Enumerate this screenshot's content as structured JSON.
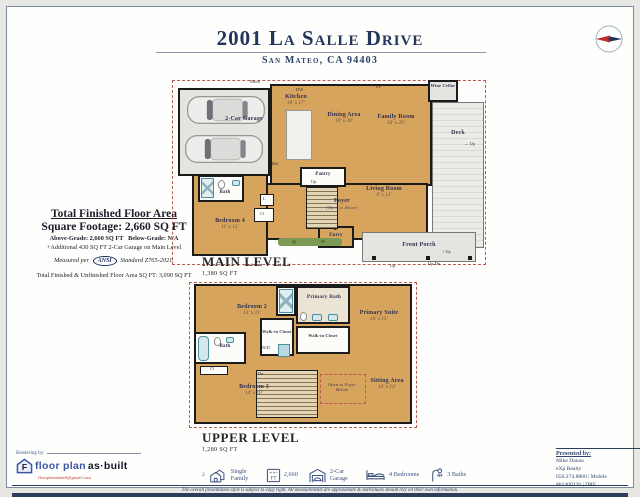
{
  "header": {
    "title": "2001 La Salle Drive",
    "subtitle": "San Mateo, CA 94403"
  },
  "area": {
    "title_line1": "Total Finished Floor Area",
    "title_line2": "Square Footage: 2,660 SQ FT",
    "above_grade": "Above-Grade: 2,660 SQ FT",
    "below_grade": "Below-Grade: N/A",
    "additional": "+Additional 430 SQ FT 2-Car Garage on Main Level",
    "measured_prefix": "Measured per",
    "ansi_label": "ANSI",
    "measured_suffix": "Standard Z765-2021.",
    "total_line": "Total Finished & Unfinished Floor Area SQ FT: 3,090 SQ FT"
  },
  "main": {
    "title": "MAIN LEVEL",
    "sqft": "1,380 SQ FT",
    "rooms": {
      "garage": {
        "name": "2-Car Garage"
      },
      "kitchen": {
        "name": "Kitchen",
        "dims": "10' x 17'"
      },
      "dining": {
        "name": "Dining Area",
        "dims": "10' x 20'"
      },
      "family": {
        "name": "Family Room",
        "dims": "16' x 20'"
      },
      "deck": {
        "name": "Deck"
      },
      "wine": {
        "name": "Wine Cellar"
      },
      "pantry": {
        "name": "Pantry"
      },
      "bath": {
        "name": "Bath"
      },
      "bedroom4": {
        "name": "Bedroom 4",
        "dims": "11' x 12'"
      },
      "foyer": {
        "name": "Foyer",
        "note": "(Open to Above)"
      },
      "living": {
        "name": "Living Room",
        "dims": "9' x 12'"
      },
      "entry": {
        "name": "Entry"
      },
      "porch": {
        "name": "Front Porch"
      }
    }
  },
  "upper": {
    "title": "UPPER LEVEL",
    "sqft": "1,280 SQ FT",
    "rooms": {
      "bedroom2": {
        "name": "Bedroom 2",
        "dims": "13' x 11'"
      },
      "primary_bath": {
        "name": "Primary Bath"
      },
      "primary_suite": {
        "name": "Primary Suite",
        "dims": "14' x 15'"
      },
      "wic1": {
        "name": "Walk-in Closet"
      },
      "wic2": {
        "name": "Walk-in Closet"
      },
      "bath": {
        "name": "Bath"
      },
      "bedroom3": {
        "name": "Bedroom 3",
        "dims": "14' x 10'"
      },
      "sitting": {
        "name": "Sitting Area",
        "dims": "10' x 13'"
      },
      "open_foyer": "Open to Foyer Below"
    }
  },
  "tags": {
    "up": "Up",
    "dn": "Dn",
    "updn": "Up Dn",
    "dw": "DW",
    "fp": "FP",
    "ref": "Ref",
    "cl": "Cl",
    "l": "L",
    "mech": "Mech",
    "wd": "W/D",
    "tri": "▲",
    "up_arrow": "↑",
    "right_arrow": "→"
  },
  "bar": {
    "items": [
      {
        "prefix": "2",
        "label": "Single Family"
      },
      {
        "label": "2,660",
        "icon_text": "FT"
      },
      {
        "label": "2-Car Garage"
      },
      {
        "label": "4 Bedrooms"
      },
      {
        "label": "3 Baths"
      }
    ]
  },
  "rendering": {
    "heading": "Rendering by:",
    "monogram": "F",
    "brand_blue": "floor plan",
    "brand_dark": "as·built",
    "email": "floorplanasbuilt@gmail.com"
  },
  "presented": {
    "heading": "Presented by:",
    "name": "Mike Danao",
    "company": "eXp Realty",
    "phone": "650.274.8860 | Mobile",
    "license": "#01400226 | DRE"
  },
  "footer": {
    "disclaimer": "The overall presentation style is subject to copy right. All measurements are approximate & individuals should rely on their own information."
  }
}
